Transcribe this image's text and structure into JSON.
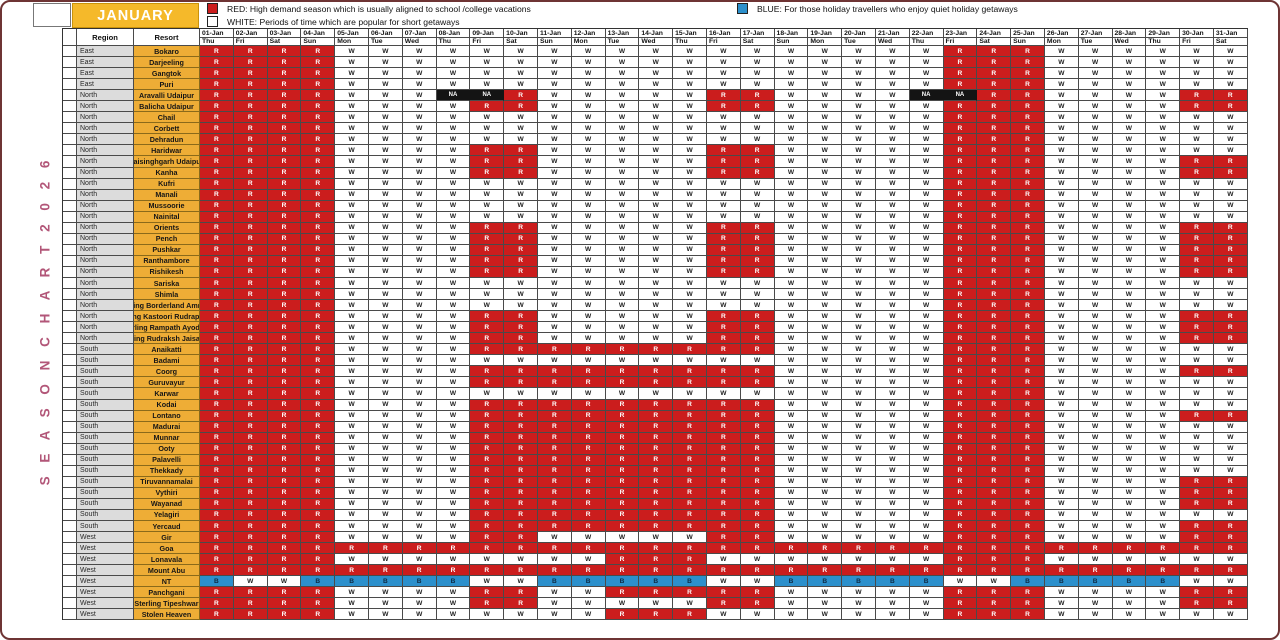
{
  "banner": {
    "month_label": "JANUARY",
    "bg": "#f5b92a"
  },
  "vertical_label": {
    "text": "S E A S O N  C H A R T  2 0 2 6",
    "color": "#b25678"
  },
  "legend": [
    {
      "name": "red",
      "color": "#cb1d1d",
      "text": "RED: High demand season which is usually aligned to school /college vacations"
    },
    {
      "name": "white",
      "color": "#ffffff",
      "text": "WHITE: Periods of time which are popular for short getaways"
    },
    {
      "name": "blue",
      "color": "#2c90cc",
      "text": "BLUE: For those holiday travellers who enjoy quiet holiday getaways"
    }
  ],
  "table_headers": {
    "region": "Region",
    "resort": "Resort"
  },
  "cell_colors": {
    "R": "#cb1d1d",
    "W": "#ffffff",
    "B": "#2c90cc",
    "N": "#141414"
  },
  "chart_data": {
    "type": "heatmap",
    "title": "SEASON CHART 2026",
    "month": "JANUARY",
    "x_dates": [
      "01-Jan",
      "02-Jan",
      "03-Jan",
      "04-Jan",
      "05-Jan",
      "06-Jan",
      "07-Jan",
      "08-Jan",
      "09-Jan",
      "10-Jan",
      "11-Jan",
      "12-Jan",
      "13-Jan",
      "14-Jan",
      "15-Jan",
      "16-Jan",
      "17-Jan",
      "18-Jan",
      "19-Jan",
      "20-Jan",
      "21-Jan",
      "22-Jan",
      "23-Jan",
      "24-Jan",
      "25-Jan",
      "26-Jan",
      "27-Jan",
      "28-Jan",
      "29-Jan",
      "30-Jan",
      "31-Jan"
    ],
    "x_days": [
      "Thu",
      "Fri",
      "Sat",
      "Sun",
      "Mon",
      "Tue",
      "Wed",
      "Thu",
      "Fri",
      "Sat",
      "Sun",
      "Mon",
      "Tue",
      "Wed",
      "Thu",
      "Fri",
      "Sat",
      "Sun",
      "Mon",
      "Tue",
      "Wed",
      "Thu",
      "Fri",
      "Sat",
      "Sun",
      "Mon",
      "Tue",
      "Wed",
      "Thu",
      "Fri",
      "Sat"
    ],
    "code_meanings": {
      "R": "High demand (red)",
      "W": "Short getaway (white)",
      "B": "Quiet getaway (blue)",
      "N": "NA"
    },
    "rows": [
      {
        "region": "East",
        "resort": "Bokaro",
        "codes": "RRRRWWWWWWWWWWWWWWWWWWRRRWWWWWW"
      },
      {
        "region": "East",
        "resort": "Darjeeling",
        "codes": "RRRRWWWWWWWWWWWWWWWWWWRRRWWWWWW"
      },
      {
        "region": "East",
        "resort": "Gangtok",
        "codes": "RRRRWWWWWWWWWWWWWWWWWWRRRWWWWWW"
      },
      {
        "region": "East",
        "resort": "Puri",
        "codes": "RRRRWWWWWWWWWWWWWWWWWWRRRWWWWWW"
      },
      {
        "region": "North",
        "resort": "Aravalli Udaipur",
        "codes": "RRRRWWWNNRWWWWWRRWWWWNNRRWWWWRR"
      },
      {
        "region": "North",
        "resort": "Balicha Udaipur",
        "codes": "RRRRWWWWRRWWWWWRRWWWWWRRRWWWWRR"
      },
      {
        "region": "North",
        "resort": "Chail",
        "codes": "RRRRWWWWWWWWWWWWWWWWWWRRRWWWWWW"
      },
      {
        "region": "North",
        "resort": "Corbett",
        "codes": "RRRRWWWWWWWWWWWWWWWWWWRRRWWWWWW"
      },
      {
        "region": "North",
        "resort": "Dehradun",
        "codes": "RRRRWWWWWWWWWWWWWWWWWWRRRWWWWWW"
      },
      {
        "region": "North",
        "resort": "Haridwar",
        "codes": "RRRRWWWWRRWWWWWRRWWWWWRRRWWWWWW"
      },
      {
        "region": "North",
        "resort": "Jaisinghgarh Udaipur",
        "codes": "RRRRWWWWRRWWWWWRRWWWWWRRRWWWWRR"
      },
      {
        "region": "North",
        "resort": "Kanha",
        "codes": "RRRRWWWWRRWWWWWRRWWWWWRRRWWWWRR"
      },
      {
        "region": "North",
        "resort": "Kufri",
        "codes": "RRRRWWWWWWWWWWWWWWWWWWRRRWWWWWW"
      },
      {
        "region": "North",
        "resort": "Manali",
        "codes": "RRRRWWWWWWWWWWWWWWWWWWRRRWWWWWW"
      },
      {
        "region": "North",
        "resort": "Mussoorie",
        "codes": "RRRRWWWWWWWWWWWWWWWWWWRRRWWWWWW"
      },
      {
        "region": "North",
        "resort": "Nainital",
        "codes": "RRRRWWWWWWWWWWWWWWWWWWRRRWWWWWW"
      },
      {
        "region": "North",
        "resort": "Orients",
        "codes": "RRRRWWWWRRWWWWWRRWWWWWRRRWWWWRR"
      },
      {
        "region": "North",
        "resort": "Pench",
        "codes": "RRRRWWWWRRWWWWWRRWWWWWRRRWWWWRR"
      },
      {
        "region": "North",
        "resort": "Pushkar",
        "codes": "RRRRWWWWRRWWWWWRRWWWWWRRRWWWWRR"
      },
      {
        "region": "North",
        "resort": "Ranthambore",
        "codes": "RRRRWWWWRRWWWWWRRWWWWWRRRWWWWRR"
      },
      {
        "region": "North",
        "resort": "Rishikesh",
        "codes": "RRRRWWWWRRWWWWWRRWWWWWRRRWWWWRR"
      },
      {
        "region": "North",
        "resort": "Sariska",
        "codes": "RRRRWWWWWWWWWWWWWWWWWWRRRWWWWWW"
      },
      {
        "region": "North",
        "resort": "Shimla",
        "codes": "RRRRWWWWWWWWWWWWWWWWWWRRRWWWWWW"
      },
      {
        "region": "North",
        "resort": "Sterling Borderland Amritsar",
        "codes": "RRRRWWWWWWWWWWWWWWWWWWRRRWWWWWW"
      },
      {
        "region": "North",
        "resort": "Sterling Kastoori Rudraprayag",
        "codes": "RRRRWWWWRRWWWWWRRWWWWWRRRWWWWRR"
      },
      {
        "region": "North",
        "resort": "Sterling Rampath Ayodhya",
        "codes": "RRRRWWWWRRWWWWWRRWWWWWRRRWWWWRR"
      },
      {
        "region": "North",
        "resort": "Sterling Rudraksh Jaisalmer",
        "codes": "RRRRWWWWRRWWWWWRRWWWWWRRRWWWWRR"
      },
      {
        "region": "South",
        "resort": "Anaikatti",
        "codes": "RRRRWWWWRRRRRRRRRWWWWWRRRWWWWWW"
      },
      {
        "region": "South",
        "resort": "Badami",
        "codes": "RRRRWWWWWWWWWWWWWWWWWWRRRWWWWWW"
      },
      {
        "region": "South",
        "resort": "Coorg",
        "codes": "RRRRWWWWRRRRRRRRRWWWWWRRRWWWWRR"
      },
      {
        "region": "South",
        "resort": "Guruvayur",
        "codes": "RRRRWWWWRRRRRRRRRWWWWWRRRWWWWWW"
      },
      {
        "region": "South",
        "resort": "Karwar",
        "codes": "RRRRWWWWWWWWWWWWWWWWWWRRRWWWWWW"
      },
      {
        "region": "South",
        "resort": "Kodai",
        "codes": "RRRRWWWWRRRRRRRRRWWWWWRRRWWWWWW"
      },
      {
        "region": "South",
        "resort": "Lontano",
        "codes": "RRRRWWWWRRRRRRRRRWWWWWRRRWWWWRR"
      },
      {
        "region": "South",
        "resort": "Madurai",
        "codes": "RRRRWWWWRRRRRRRRRWWWWWRRRWWWWWW"
      },
      {
        "region": "South",
        "resort": "Munnar",
        "codes": "RRRRWWWWRRRRRRRRRWWWWWRRRWWWWWW"
      },
      {
        "region": "South",
        "resort": "Ooty",
        "codes": "RRRRWWWWRRRRRRRRRWWWWWRRRWWWWWW"
      },
      {
        "region": "South",
        "resort": "Palavelli",
        "codes": "RRRRWWWWRRRRRRRRRWWWWWRRRWWWWWW"
      },
      {
        "region": "South",
        "resort": "Thekkady",
        "codes": "RRRRWWWWRRRRRRRRRWWWWWRRRWWWWWW"
      },
      {
        "region": "South",
        "resort": "Tiruvannamalai",
        "codes": "RRRRWWWWRRRRRRRRRWWWWWRRRWWWWRR"
      },
      {
        "region": "South",
        "resort": "Vythiri",
        "codes": "RRRRWWWWRRRRRRRRRWWWWWRRRWWWWRR"
      },
      {
        "region": "South",
        "resort": "Wayanad",
        "codes": "RRRRWWWWRRRRRRRRRWWWWWRRRWWWWRR"
      },
      {
        "region": "South",
        "resort": "Yelagiri",
        "codes": "RRRRWWWWRRRRRRRRRWWWWWRRRWWWWWW"
      },
      {
        "region": "South",
        "resort": "Yercaud",
        "codes": "RRRRWWWWRRRRRRRRRWWWWWRRRWWWWRR"
      },
      {
        "region": "West",
        "resort": "Gir",
        "codes": "RRRRWWWWRRWWWWWRRWWWWWRRRWWWWRR"
      },
      {
        "region": "West",
        "resort": "Goa",
        "codes": "RRRRRRRRRRRRRRRRRRRRRRRRRRRRRRR"
      },
      {
        "region": "West",
        "resort": "Lonavala",
        "codes": "RRRRWWWWWWWWRRRWWWWWWWRRRWWWWWW"
      },
      {
        "region": "West",
        "resort": "Mount Abu",
        "codes": "RRRRRRRRRRRRRRRRRRRRRRRRRRRRRRR"
      },
      {
        "region": "West",
        "resort": "NT",
        "codes": "BWWBBBBBWWBBBBBWWBBBBBWWBBBBBWW"
      },
      {
        "region": "West",
        "resort": "Panchgani",
        "codes": "RRRRWWWWRRWWRRRRRWWWWWRRRWWWWRR"
      },
      {
        "region": "West",
        "resort": "Sterling Tipeshwar",
        "codes": "RRRRWWWWRRWWWWWRRWWWWWRRRWWWWRR"
      },
      {
        "region": "West",
        "resort": "Stolen Heaven",
        "codes": "RRRRWWWWWWWWRRRWWWWWWWRRRWWWWWW"
      }
    ]
  }
}
